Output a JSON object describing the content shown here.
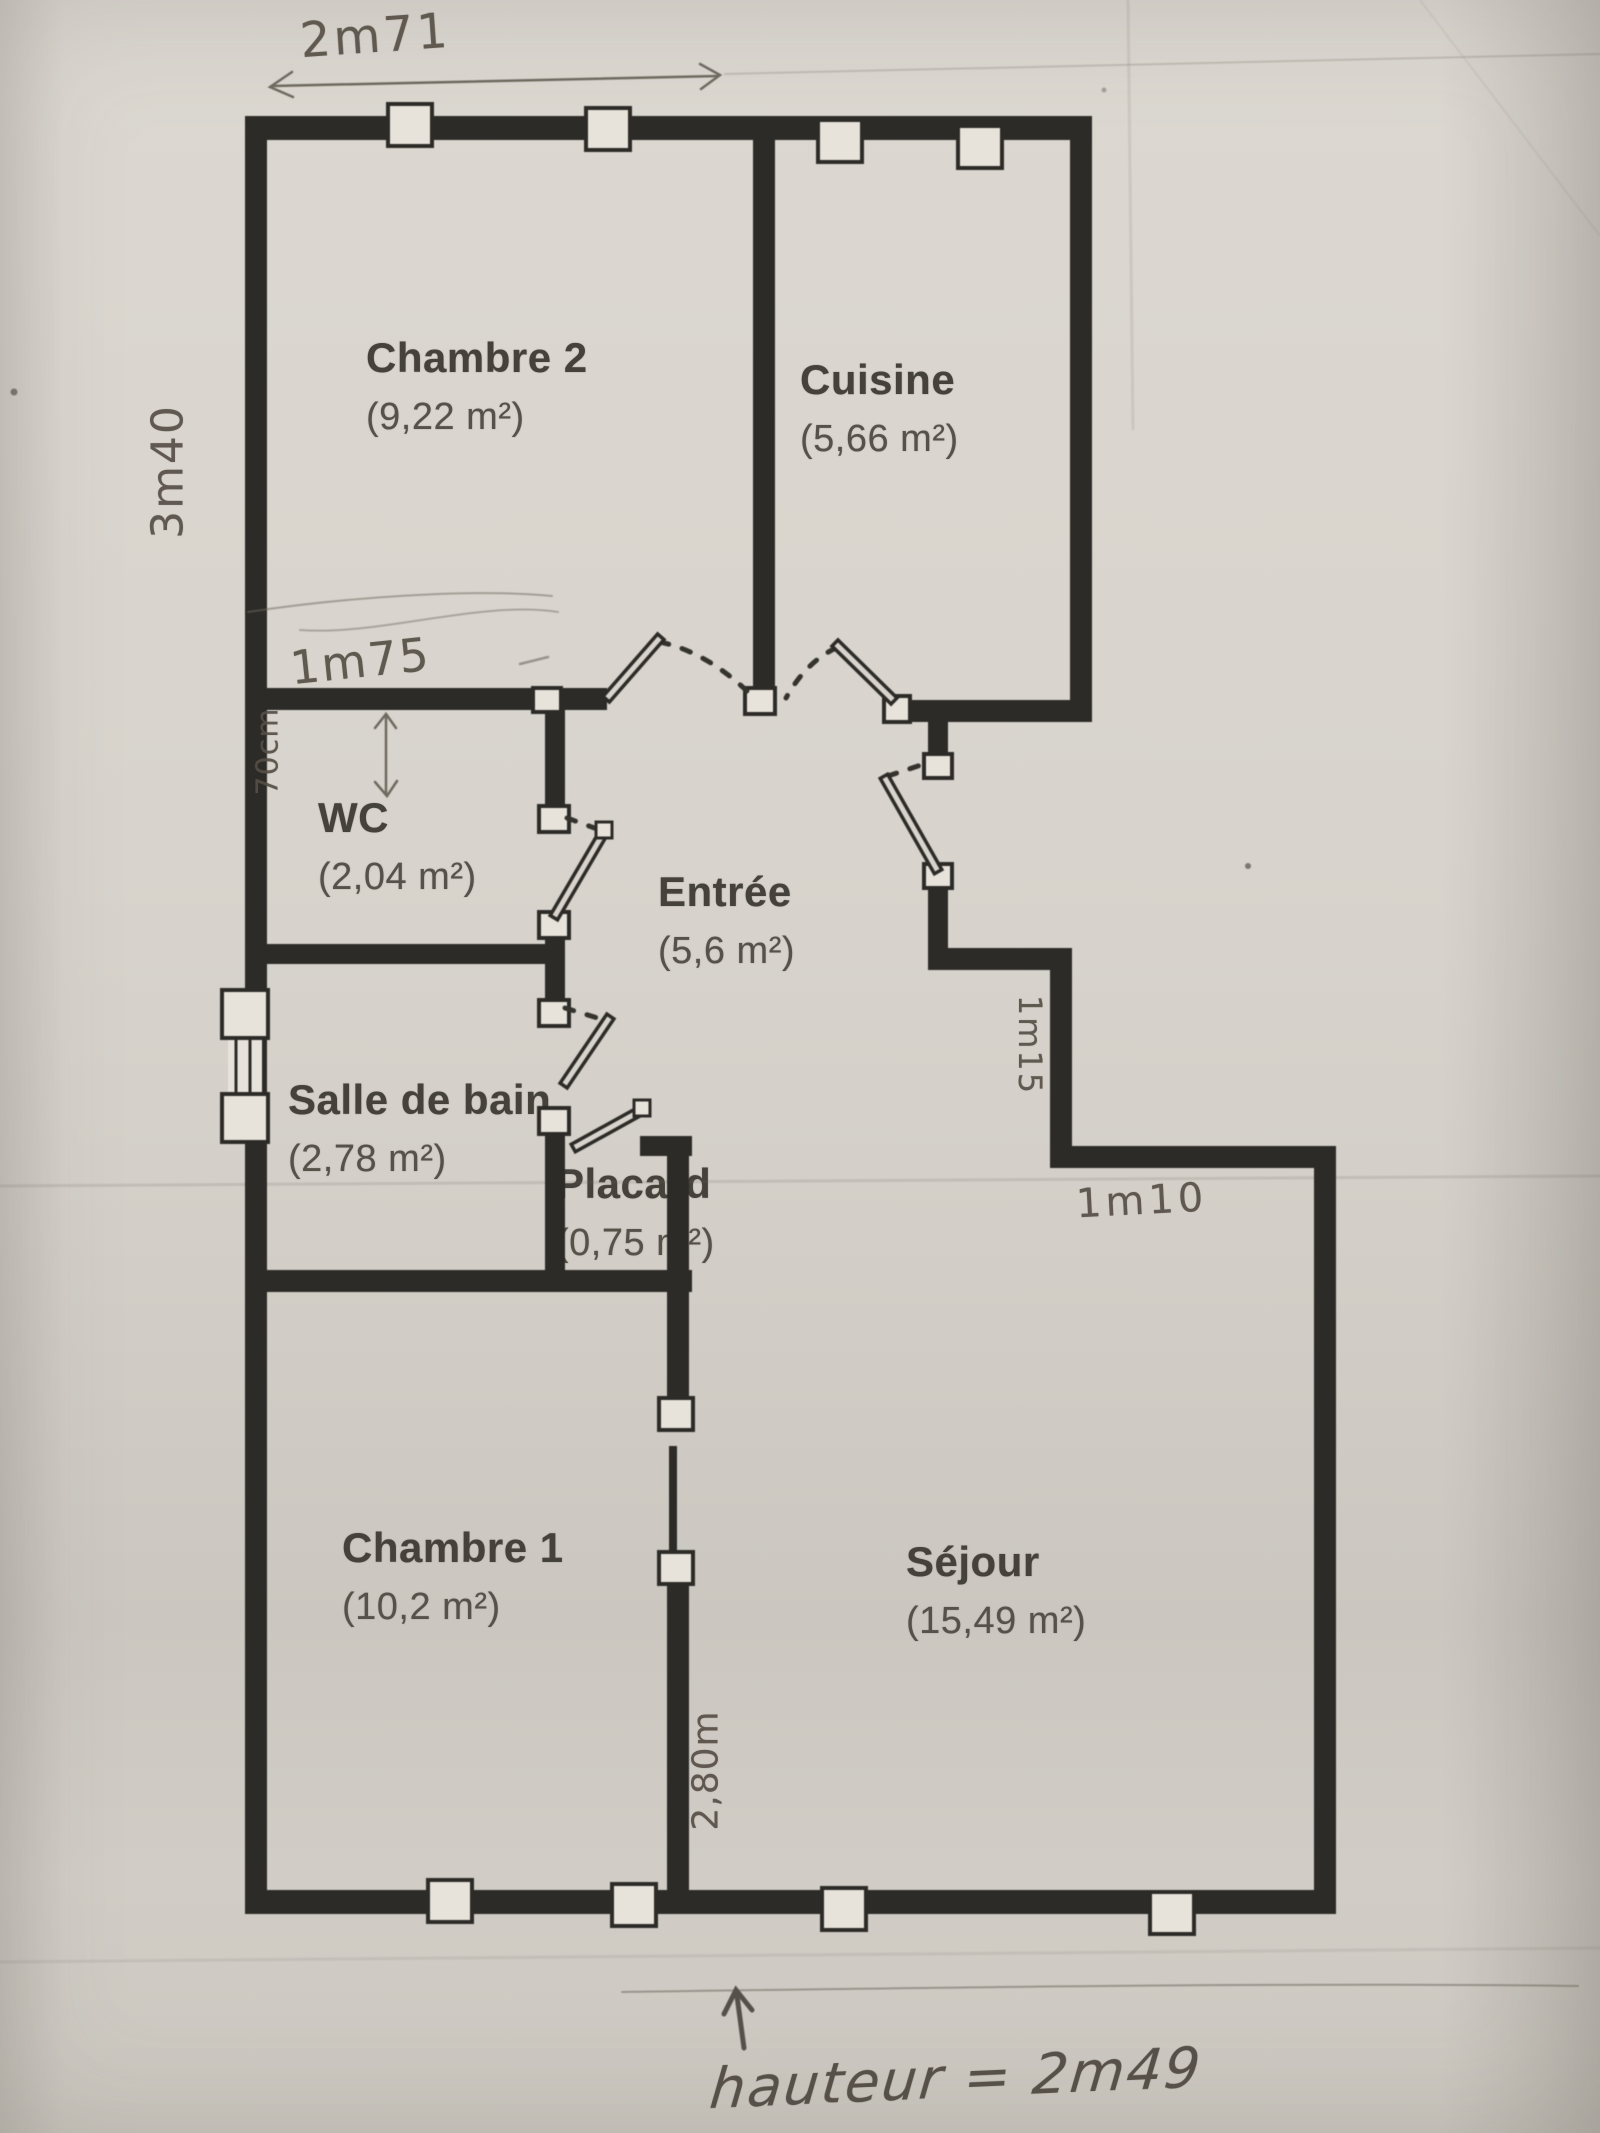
{
  "rooms": [
    {
      "name": "Chambre 2",
      "area": "(9,22 m²)"
    },
    {
      "name": "Cuisine",
      "area": "(5,66 m²)"
    },
    {
      "name": "WC",
      "area": "(2,04 m²)"
    },
    {
      "name": "Entrée",
      "area": "(5,6 m²)"
    },
    {
      "name": "Salle de bain",
      "area": "(2,78 m²)"
    },
    {
      "name": "Placard",
      "area": "(0,75 m²)"
    },
    {
      "name": "Chambre 1",
      "area": "(10,2 m²)"
    },
    {
      "name": "Séjour",
      "area": "(15,49 m²)"
    }
  ],
  "annotations": {
    "width_top": "2m71",
    "height_left": "3m40",
    "wc_wall_length": "1m75",
    "wc_width": "70cm",
    "entry_wall": "1m15",
    "sejour_wall": "1m10",
    "chambre1_wall": "2,80m",
    "ceiling_height": "hauteur = 2m49"
  },
  "colors": {
    "paper": "#d6d2cb",
    "walls": "#2d2b27",
    "pencil": "#6e695f",
    "printed_text": "#45423b"
  }
}
